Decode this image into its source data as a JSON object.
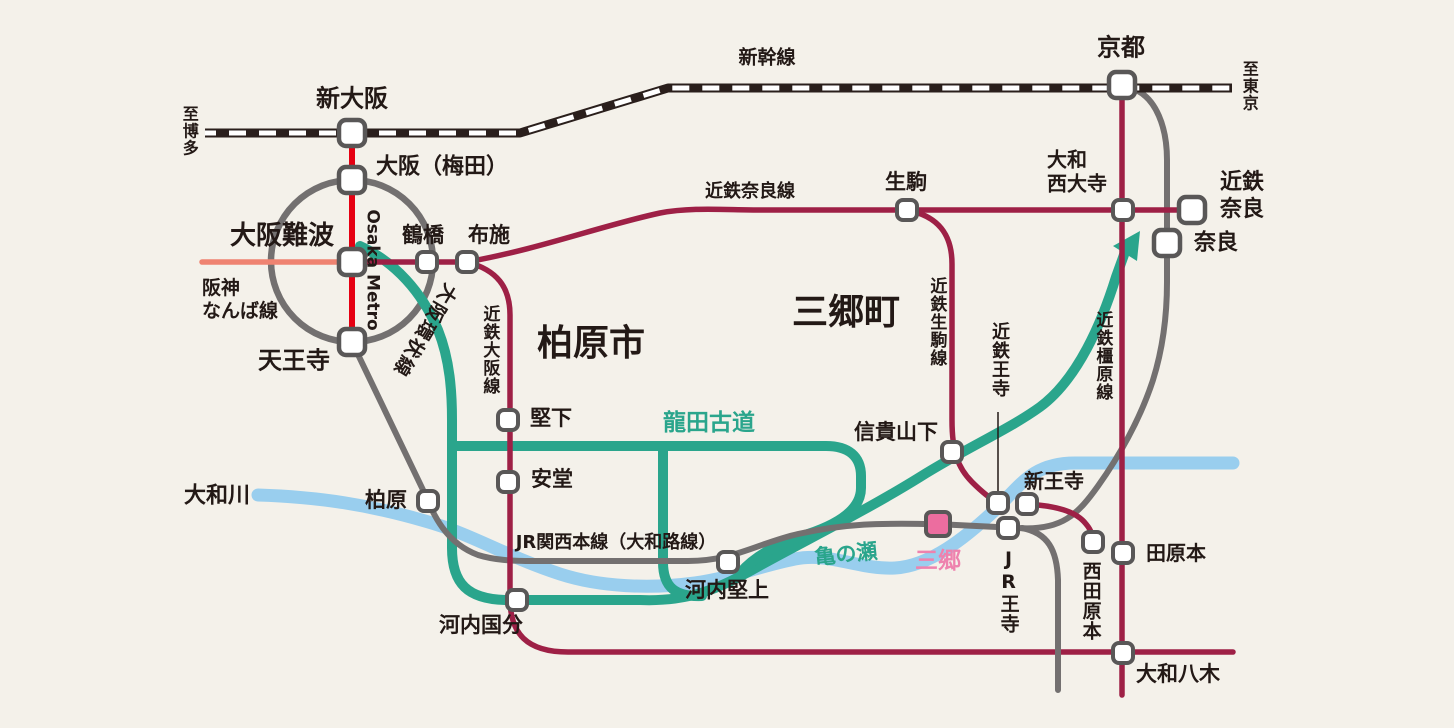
{
  "map": {
    "region_labels": {
      "kashiwara_city": "柏原市",
      "sango_town": "三郷町"
    },
    "labels": {
      "shinkansen_label": "新幹線",
      "to_hakata": "至博多",
      "to_tokyo": "至東京",
      "shin_osaka": "新大阪",
      "kyoto": "京都",
      "osaka_umeda": "大阪（梅田）",
      "osaka_namba": "大阪難波",
      "hanshin_namba_line": "阪神\nなんば線",
      "osaka_metro": "Osaka Metro",
      "osaka_loop_line": "大阪環状線",
      "tsuruhashi": "鶴橋",
      "fuse": "布施",
      "tennoji": "天王寺",
      "kintetsu_nara_line": "近鉄奈良線",
      "ikoma": "生駒",
      "yamato_saidaiji": "大和\n西大寺",
      "kintetsu_nara": "近鉄\n奈良",
      "nara": "奈良",
      "kashiwara_city": "柏原市",
      "sango_town": "三郷町",
      "kintetsu_osaka_line": "近鉄大阪線",
      "katashimo": "堅下",
      "ando": "安堂",
      "tatsuta_kodo": "龍田古道",
      "kintetsu_ikoma_line": "近鉄生駒線",
      "kintetsu_oji": "近鉄王寺",
      "kintetsu_kashihara_line": "近鉄橿原線",
      "shigisanshita": "信貴山下",
      "yamato_river": "大和川",
      "kashiwara_sta": "柏原",
      "jr_kansai_line": "JR関西本線（大和路線）",
      "kawachi_katakami": "河内堅上",
      "kame_no_se": "亀の瀬",
      "sango_sta": "三郷",
      "kawachi_kokubu": "河内国分",
      "shin_oji": "新王寺",
      "jr_oji": "JR王寺",
      "nishi_tawaramoto": "西田原本",
      "tawaramoto": "田原本",
      "yamato_yagi": "大和八木"
    },
    "lines": [
      {
        "id": "shinkansen",
        "name": "新幹線",
        "style": "black-white-dashed",
        "color": "#2a1f1c"
      },
      {
        "id": "osaka-loop-line",
        "name": "大阪環状線",
        "color": "#737070"
      },
      {
        "id": "jr-kansai-main-line",
        "name": "JR関西本線（大和路線）",
        "color": "#737070"
      },
      {
        "id": "osaka-metro",
        "name": "Osaka Metro",
        "color": "#e60012"
      },
      {
        "id": "hanshin-namba-line",
        "name": "阪神なんば線",
        "color": "#ef8371"
      },
      {
        "id": "kintetsu-nara-line",
        "name": "近鉄奈良線",
        "color": "#9e2046"
      },
      {
        "id": "kintetsu-osaka-line",
        "name": "近鉄大阪線",
        "color": "#9e2046"
      },
      {
        "id": "kintetsu-ikoma-line",
        "name": "近鉄生駒線",
        "color": "#9e2046"
      },
      {
        "id": "kintetsu-kashihara-line",
        "name": "近鉄橿原線",
        "color": "#9e2046"
      },
      {
        "id": "tatsuta-kodo-road",
        "name": "龍田古道",
        "color": "#2aa58c"
      },
      {
        "id": "yamato-river",
        "name": "大和川",
        "color": "#99ceee"
      }
    ],
    "stations": [
      {
        "name": "新大阪",
        "marker": "white",
        "size": "large"
      },
      {
        "name": "大阪（梅田）",
        "marker": "white",
        "size": "large"
      },
      {
        "name": "大阪難波",
        "marker": "white",
        "size": "large"
      },
      {
        "name": "天王寺",
        "marker": "white",
        "size": "large"
      },
      {
        "name": "京都",
        "marker": "white",
        "size": "large"
      },
      {
        "name": "近鉄奈良",
        "marker": "white",
        "size": "large"
      },
      {
        "name": "奈良",
        "marker": "white",
        "size": "large"
      },
      {
        "name": "鶴橋",
        "marker": "white",
        "size": "small"
      },
      {
        "name": "布施",
        "marker": "white",
        "size": "small"
      },
      {
        "name": "生駒",
        "marker": "white",
        "size": "small"
      },
      {
        "name": "大和西大寺",
        "marker": "white",
        "size": "small"
      },
      {
        "name": "堅下",
        "marker": "white",
        "size": "small"
      },
      {
        "name": "安堂",
        "marker": "white",
        "size": "small"
      },
      {
        "name": "柏原",
        "marker": "white",
        "size": "small"
      },
      {
        "name": "河内国分",
        "marker": "white",
        "size": "small"
      },
      {
        "name": "河内堅上",
        "marker": "white",
        "size": "small"
      },
      {
        "name": "信貴山下",
        "marker": "white",
        "size": "small"
      },
      {
        "name": "近鉄王寺",
        "marker": "white",
        "size": "small"
      },
      {
        "name": "新王寺",
        "marker": "white",
        "size": "small"
      },
      {
        "name": "JR王寺",
        "marker": "white",
        "size": "small"
      },
      {
        "name": "三郷",
        "marker": "pink",
        "size": "large"
      },
      {
        "name": "西田原本",
        "marker": "white",
        "size": "small"
      },
      {
        "name": "田原本",
        "marker": "white",
        "size": "small"
      },
      {
        "name": "大和八木",
        "marker": "white",
        "size": "small"
      }
    ],
    "colors": {
      "background": "#f4f1ea",
      "text": "#231916",
      "kintetsu_crimson": "#9e2046",
      "metro_red": "#e60012",
      "hanshin_salmon": "#ef8371",
      "jr_gray": "#737070",
      "road_teal": "#2aa58c",
      "river_blue": "#99ceee",
      "sango_pink_fill": "#ec6d9f",
      "sango_pink_text": "#ee82ae",
      "station_border": "#595757",
      "shinkansen_black": "#2a1f1c"
    }
  }
}
